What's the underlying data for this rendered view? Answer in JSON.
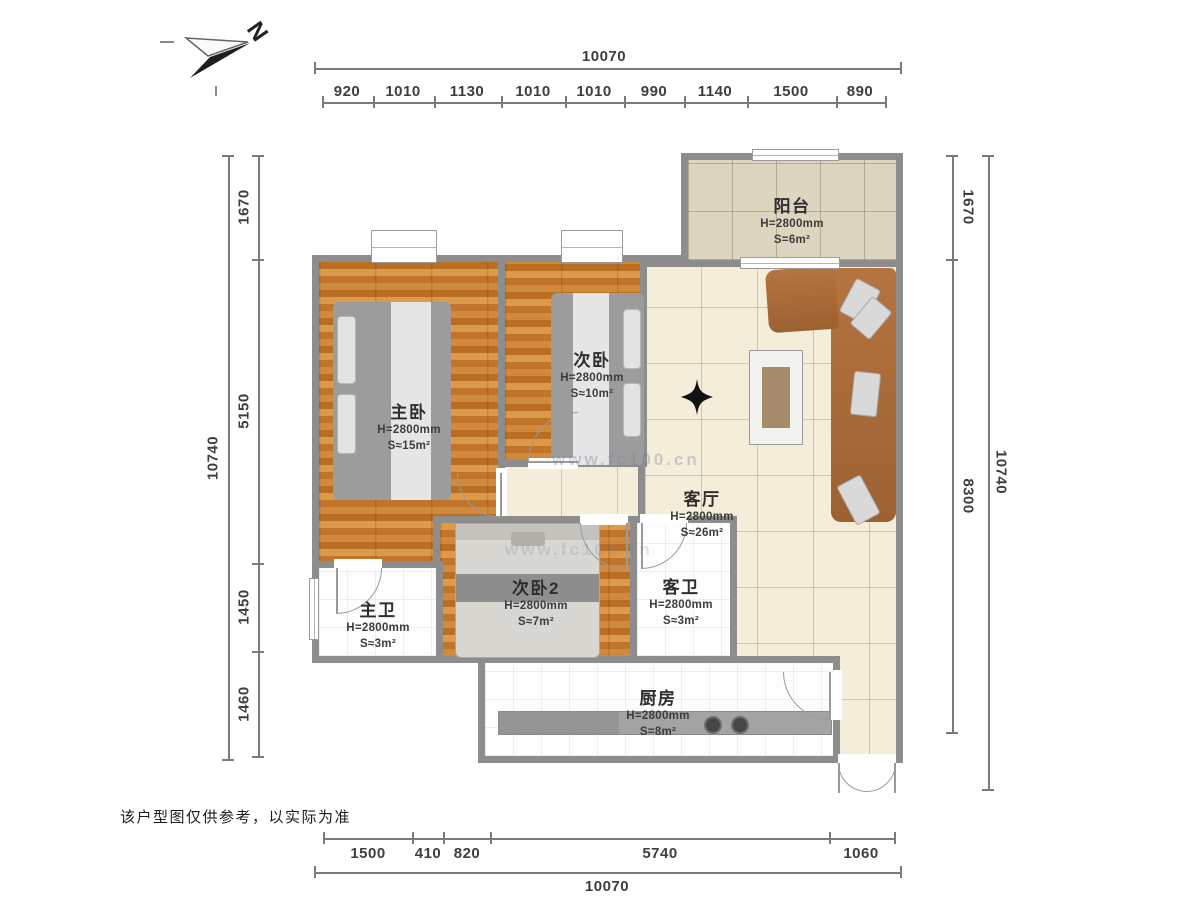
{
  "meta": {
    "type": "residential-floor-plan"
  },
  "compass": {
    "label": "N"
  },
  "disclaimer": "该户型图仅供参考，以实际为准",
  "watermark": {
    "text": "www.fc100.cn"
  },
  "dimensions": {
    "top": {
      "total": "10070",
      "segments": [
        "920",
        "1010",
        "1130",
        "1010",
        "1010",
        "990",
        "1140",
        "1500",
        "890"
      ]
    },
    "bottom": {
      "total": "10070",
      "segments": [
        "1500",
        "410",
        "820",
        "5740",
        "1060"
      ]
    },
    "left": {
      "total": "10740",
      "segments": [
        "1670",
        "5150",
        "1450",
        "1460"
      ]
    },
    "right": {
      "total": "10740",
      "segments": [
        "1670",
        "8300"
      ]
    }
  },
  "rooms": [
    {
      "id": "balcony",
      "name": "阳台",
      "height": "H=2800mm",
      "area": "S=6m²"
    },
    {
      "id": "master-bedroom",
      "name": "主卧",
      "height": "H=2800mm",
      "area": "S≈15m²"
    },
    {
      "id": "bedroom-2",
      "name": "次卧",
      "height": "H=2800mm",
      "area": "S≈10m²"
    },
    {
      "id": "living-room",
      "name": "客厅",
      "height": "H=2800mm",
      "area": "S≈26m²"
    },
    {
      "id": "bedroom-3",
      "name": "次卧2",
      "height": "H=2800mm",
      "area": "S≈7m²"
    },
    {
      "id": "master-bath",
      "name": "主卫",
      "height": "H=2800mm",
      "area": "S≈3m²"
    },
    {
      "id": "guest-bath",
      "name": "客卫",
      "height": "H=2800mm",
      "area": "S≈3m²"
    },
    {
      "id": "kitchen",
      "name": "厨房",
      "height": "H=2800mm",
      "area": "S=8m²"
    }
  ],
  "colors": {
    "wall": "#8d8d8d",
    "wood_floor": "#c97f35",
    "living_tile": "#f4edda",
    "balcony_tile": "#ddd5c0",
    "bath_floor": "#fdfdfd",
    "sofa": "#a96b3c",
    "bed": "#9c9c9c",
    "dimension_text": "#3e3e3e"
  }
}
